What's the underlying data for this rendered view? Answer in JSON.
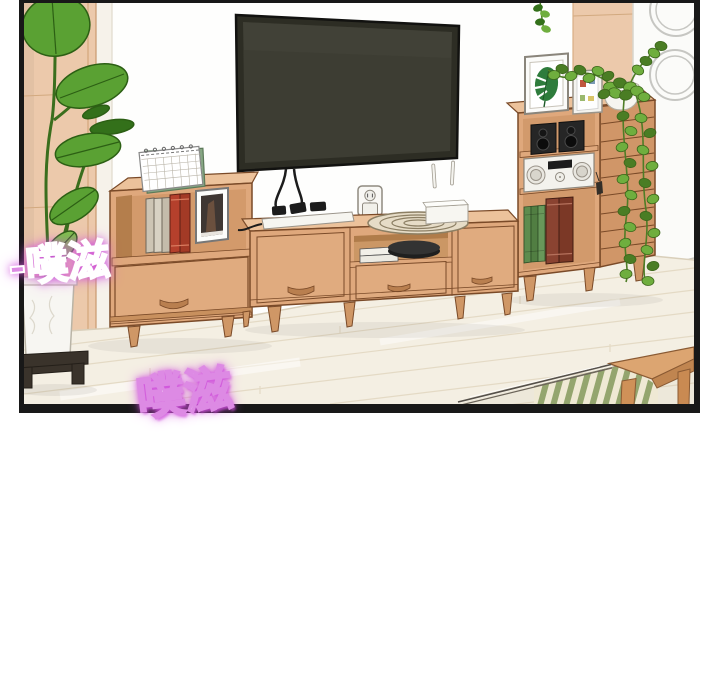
{
  "scene": {
    "type": "webtoon panel illustration",
    "setting": "living room wall with wooden media furniture, plants and electronics",
    "objects": [
      "floor plant in white planter on dark wood stand",
      "desk calendar",
      "beige and red books",
      "photo frame",
      "flat-screen TV",
      "power strip with black cables",
      "wall outlet with plug",
      "coiled cable",
      "wifi router with two antennas",
      "low TV console with drawers",
      "stacked media boxes",
      "black disc device",
      "tall audio cabinet",
      "two bookshelf speakers",
      "stereo receiver",
      "framed monstera print",
      "small postcard frame",
      "pothos plant in white pot trailing down cabinet",
      "slatted cabinet side",
      "white column with two rings",
      "tan wall panels",
      "light wood plank floor",
      "glass table edge in foreground",
      "wooden side table corner",
      "striped mat seen under glass"
    ]
  },
  "sfx": [
    {
      "id": "sfx-left",
      "text": "-噗滋",
      "style": "pink fill, white outline, magenta glow"
    },
    {
      "id": "sfx-bottom",
      "text": "噗滋",
      "style": "white fill, magenta outline and glow"
    }
  ],
  "palette": {
    "panel-border": "#181818",
    "wall": "#fefefd",
    "wall-tan": "#ecc9ab",
    "wood-front": "#dfa87c",
    "wood-top": "#ecc29b",
    "wood-side": "#d09668",
    "wood-line": "#7a4a28",
    "floor": "#f4efe3",
    "floor-line": "#e4dac5",
    "leaf": "#5aa133",
    "leaf-dark": "#33701a",
    "leaf-light": "#7cc24a",
    "pothos": "#6fae3e",
    "pothos-dark": "#4a7d24",
    "tv-frame": "#2d2d24",
    "tv-screen": "#3d3d33",
    "white-item": "#f6f5f1",
    "black-item": "#262626",
    "book-red": "#b5402c",
    "book-beige": "#cdc5b4",
    "book-green": "#5e8c4e",
    "book-maroon": "#8a4331",
    "sfx-pink": "#dd8ae4",
    "sfx-glow": "#cf4fdc"
  }
}
